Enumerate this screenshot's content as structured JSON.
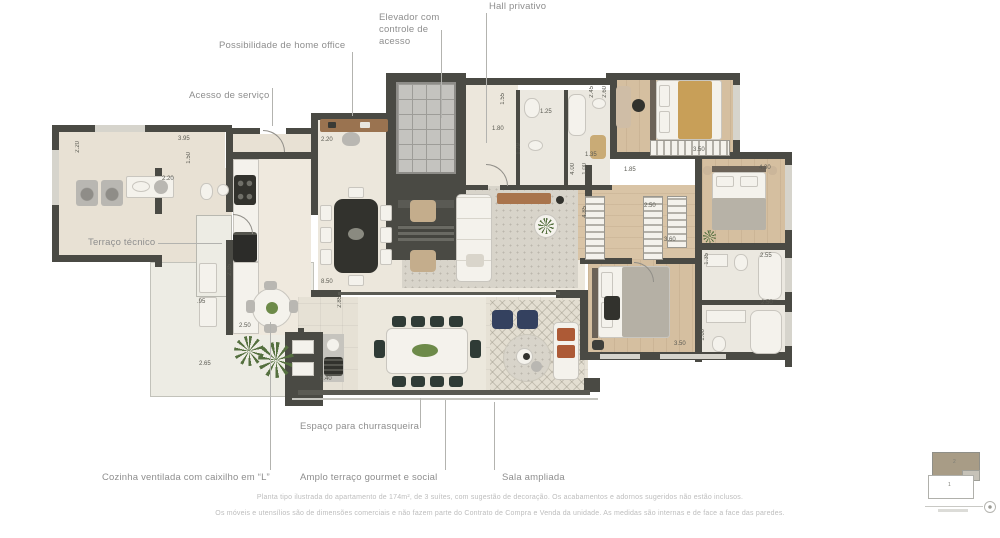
{
  "palette": {
    "wall": "#4a4a44",
    "floor_main": "#ece7dc",
    "floor_wood": "#d5bfa0",
    "floor_service": "#e8e1d4",
    "floor_terrace": "#e6e1d5",
    "label_gray": "#8e8e8e",
    "dim_gray": "#5a5a52",
    "disclaimer_gray": "#bdbdbd",
    "navy_chair": "#34415f",
    "tan_blanket": "#c89f58",
    "plant_green": "#55703f",
    "keyplan_tan": "#a89c86"
  },
  "callouts": {
    "home_office": "Possibilidade de home office",
    "elevador": "Elevador com controle de acesso",
    "hall_privativo": "Hall privativo",
    "acesso_servico": "Acesso de serviço",
    "terraco_tecnico": "Terraço técnico",
    "churrasqueira": "Espaço para churrasqueira",
    "cozinha": "Cozinha ventilada com caixilho em “L”",
    "terraco_gourmet": "Amplo terraço gourmet e social",
    "sala_ampliada": "Sala ampliada"
  },
  "dimensions": [
    {
      "t": "2.20",
      "x": 75,
      "y": 141,
      "v": 1
    },
    {
      "t": "3.95",
      "x": 178,
      "y": 136,
      "v": 0
    },
    {
      "t": "1.50",
      "x": 186,
      "y": 152,
      "v": 1
    },
    {
      "t": "2.20",
      "x": 162,
      "y": 176,
      "v": 0
    },
    {
      "t": "2.20",
      "x": 321,
      "y": 137,
      "v": 0
    },
    {
      "t": "2.35",
      "x": 227,
      "y": 264,
      "v": 1
    },
    {
      "t": ".95",
      "x": 197,
      "y": 299,
      "v": 0
    },
    {
      "t": "2.50",
      "x": 239,
      "y": 323,
      "v": 0
    },
    {
      "t": "2.65",
      "x": 199,
      "y": 361,
      "v": 0
    },
    {
      "t": "8.50",
      "x": 321,
      "y": 279,
      "v": 0
    },
    {
      "t": "2.85",
      "x": 337,
      "y": 296,
      "v": 1
    },
    {
      "t": "6.40",
      "x": 320,
      "y": 376,
      "v": 0
    },
    {
      "t": "1.55",
      "x": 500,
      "y": 93,
      "v": 1
    },
    {
      "t": "1.80",
      "x": 492,
      "y": 126,
      "v": 0
    },
    {
      "t": "1.25",
      "x": 540,
      "y": 109,
      "v": 0
    },
    {
      "t": "1.79",
      "x": 516,
      "y": 143,
      "v": 1
    },
    {
      "t": "1.35",
      "x": 585,
      "y": 152,
      "v": 0
    },
    {
      "t": "2.45",
      "x": 589,
      "y": 86,
      "v": 1
    },
    {
      "t": "2.60",
      "x": 602,
      "y": 86,
      "v": 1
    },
    {
      "t": "3.50",
      "x": 693,
      "y": 147,
      "v": 0
    },
    {
      "t": "4.30",
      "x": 759,
      "y": 165,
      "v": 0
    },
    {
      "t": "4.00",
      "x": 570,
      "y": 163,
      "v": 1
    },
    {
      "t": "1.00",
      "x": 582,
      "y": 163,
      "v": 1
    },
    {
      "t": "1.85",
      "x": 624,
      "y": 167,
      "v": 0
    },
    {
      "t": "2.50",
      "x": 644,
      "y": 203,
      "v": 0
    },
    {
      "t": "4.85",
      "x": 582,
      "y": 206,
      "v": 1
    },
    {
      "t": "3.60",
      "x": 664,
      "y": 237,
      "v": 0
    },
    {
      "t": "1.35",
      "x": 704,
      "y": 253,
      "v": 1
    },
    {
      "t": "2.55",
      "x": 760,
      "y": 253,
      "v": 0
    },
    {
      "t": "2.50",
      "x": 761,
      "y": 300,
      "v": 0
    },
    {
      "t": "1.60",
      "x": 700,
      "y": 329,
      "v": 1
    },
    {
      "t": "3.50",
      "x": 674,
      "y": 341,
      "v": 0
    }
  ],
  "disclaimer": {
    "line1": "Planta tipo ilustrada do apartamento de 174m², de 3 suítes, com sugestão de decoração. Os acabamentos e adornos sugeridos não estão inclusos.",
    "line2": "Os móveis e utensílios são de dimensões comerciais e não fazem parte do Contrato de Compra e Venda da unidade. As medidas são internas e de face a face das paredes."
  },
  "keyplan": {
    "unit_top_label": "2",
    "unit_bottom_label": "1"
  }
}
